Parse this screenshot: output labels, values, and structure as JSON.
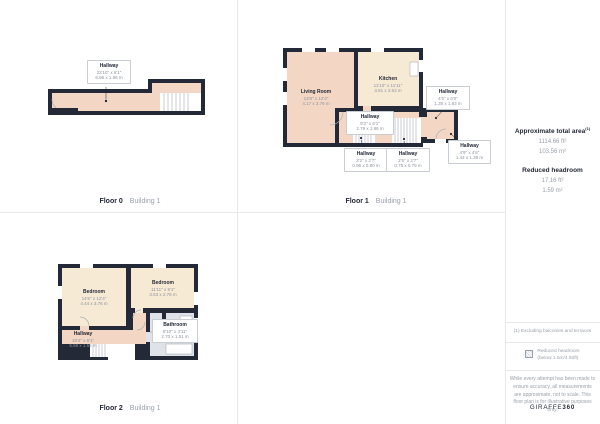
{
  "floors": [
    {
      "caption": {
        "floor": "Floor 0",
        "building": "Building 1"
      },
      "rooms": [
        {
          "name": "Hallway",
          "imperial": "22'10\" x 6'1\"",
          "metric": "6.96 x 1.86 m"
        }
      ]
    },
    {
      "caption": {
        "floor": "Floor 1",
        "building": "Building 1"
      },
      "rooms": [
        {
          "name": "Living Room",
          "imperial": "13'8\" x 12'4\"",
          "metric": "4.17 x 3.76 m"
        },
        {
          "name": "Kitchen",
          "imperial": "11'10\" x 11'11\"",
          "metric": "3.61 x 3.63 m"
        },
        {
          "name": "Hallway",
          "imperial": "9'2\" x 6'1\"",
          "metric": "2.79 x 1.86 m"
        },
        {
          "name": "Hallway",
          "imperial": "4'5\" x 6'0\"",
          "metric": "1.35 x 1.83 m"
        },
        {
          "name": "Hallway",
          "imperial": "3'2\" x 2'7\"",
          "metric": "0.96 x 0.80 m"
        },
        {
          "name": "Hallway",
          "imperial": "2'5\" x 2'7\"",
          "metric": "0.75 x 0.79 m"
        },
        {
          "name": "Hallway",
          "imperial": "4'9\" x 4'6\"",
          "metric": "1.44 x 1.39 m"
        }
      ]
    },
    {
      "caption": {
        "floor": "Floor 2",
        "building": "Building 1"
      },
      "rooms": [
        {
          "name": "Bedroom",
          "imperial": "14'6\" x 12'4\"",
          "metric": "4.44 x 3.76 m"
        },
        {
          "name": "Bedroom",
          "imperial": "11'11\" x 9'1\"",
          "metric": "3.63 x 2.76 m"
        },
        {
          "name": "Hallway",
          "imperial": "18'4\" x 5'1\"",
          "metric": "5.58 x 1.55 m"
        },
        {
          "name": "Bathroom",
          "imperial": "8'10\" x 4'11\"",
          "metric": "2.70 x 1.51 m"
        }
      ]
    }
  ],
  "sidebar": {
    "total_area": {
      "title": "Approximate total area",
      "superscript": "(1)",
      "imperial": "1114.66 ft²",
      "metric": "103.56 m²"
    },
    "reduced_headroom": {
      "title": "Reduced headroom",
      "imperial": "17.16 ft²",
      "metric": "1.59 m²"
    },
    "footnote": "(1) Excluding balconies and terraces",
    "legend": {
      "line1": "Reduced headroom",
      "line2": "(below 1.5m/4.92ft)"
    },
    "disclaimer": "While every attempt has been made to ensure accuracy, all measurements are approximate, not to scale. This floor plan is for illustrative purposes only.",
    "logo": {
      "brand": "GIRAFFE",
      "suffix": "360"
    }
  },
  "palette": {
    "wall": "#232936",
    "room_warm": "#f3d7c4",
    "room_cream": "#f7ead5",
    "room_bath": "#dfe3e9",
    "line_gray": "#a9aeb8"
  }
}
